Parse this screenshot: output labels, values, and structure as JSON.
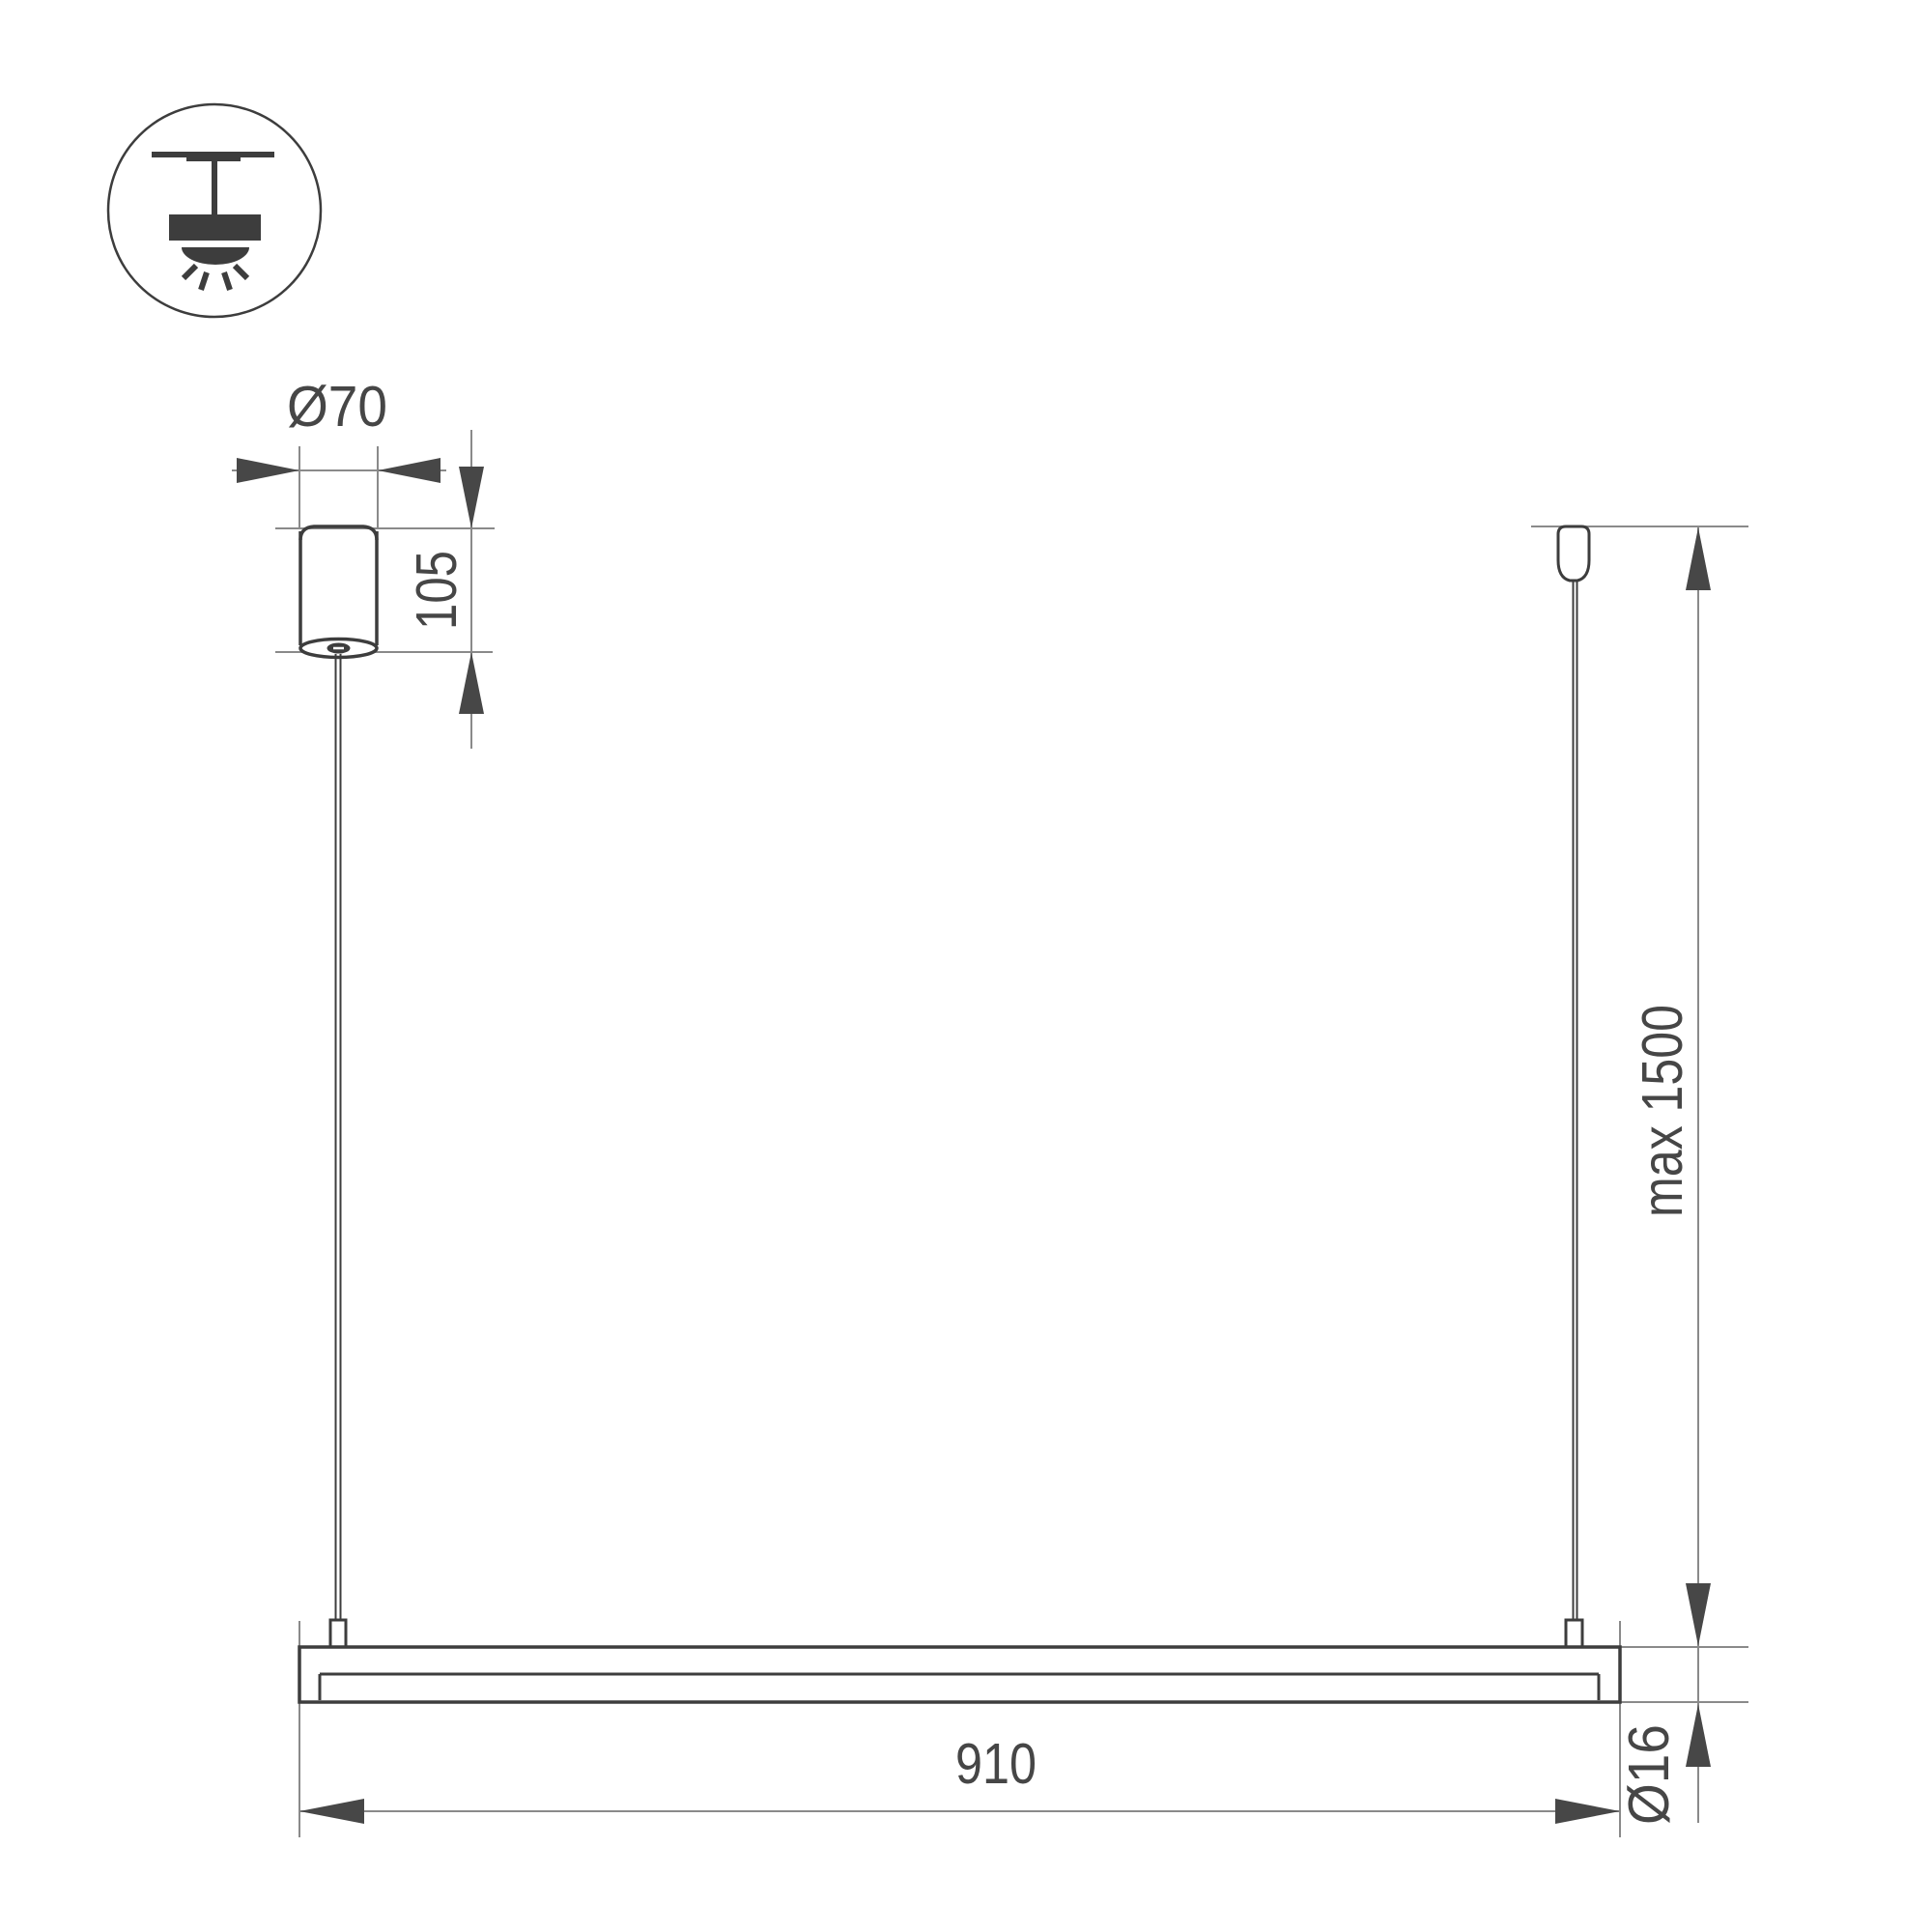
{
  "drawing": {
    "kind": "technical-dimension-drawing",
    "units_note": "millimetres (implied by drawing convention)"
  },
  "icon": {
    "name": "ceiling-pendant-mount-icon",
    "description": "pendant luminaire hanging from ceiling with downward light rays, inside a circle"
  },
  "labels": {
    "canopy_diameter": "Ø70",
    "canopy_height": "105",
    "max_suspension": "max 1500",
    "bar_length": "910",
    "bar_diameter": "Ø16"
  },
  "colors": {
    "outline": "#3d3d3d",
    "dim_line": "#8a8a8a",
    "arrow": "#474747",
    "text": "#464646",
    "bg": "#ffffff"
  }
}
